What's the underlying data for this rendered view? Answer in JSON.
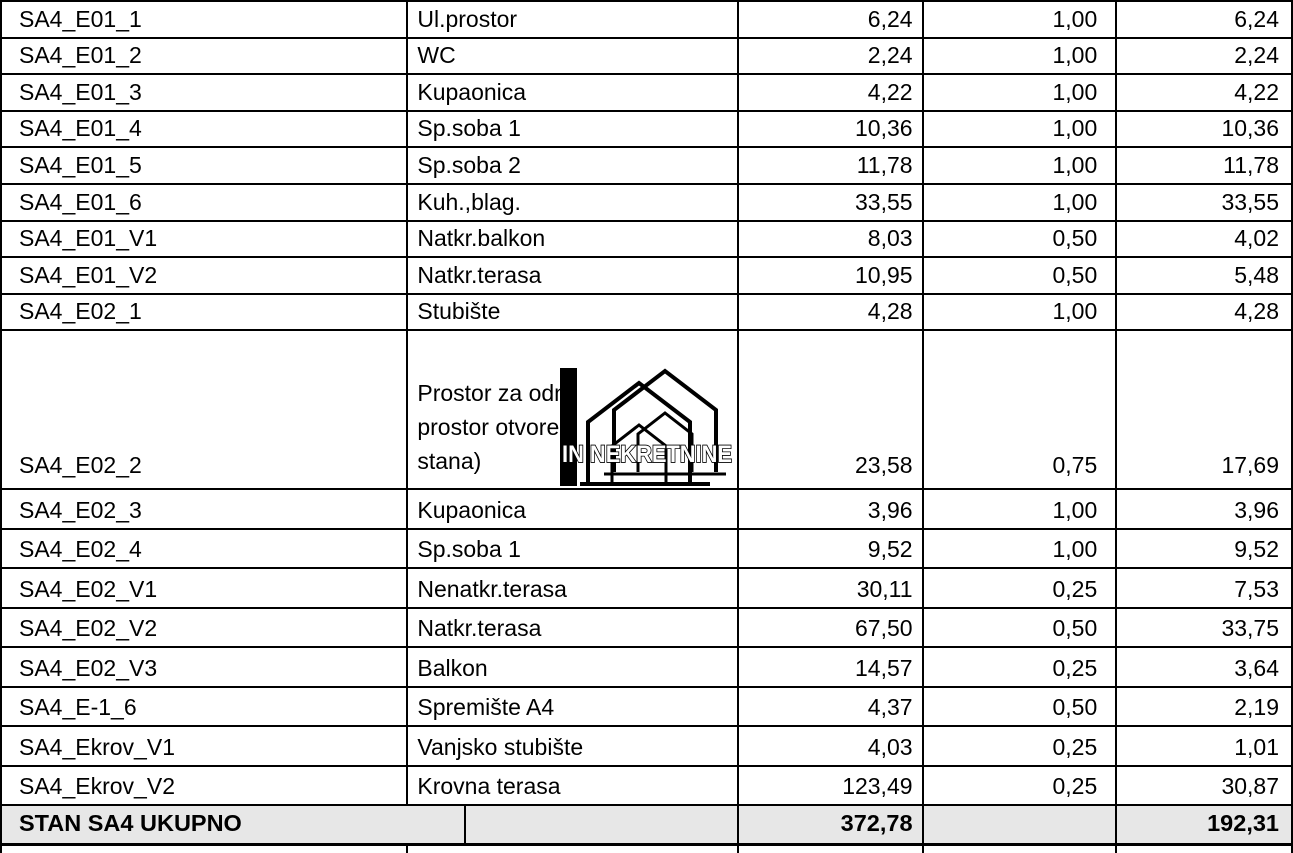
{
  "watermark": {
    "text": "IN NEKRETNINE"
  },
  "colors": {
    "border": "#000000",
    "text": "#000000",
    "total_row_bg": "#e7e7e7"
  },
  "table": {
    "rows": [
      {
        "kind": "regular",
        "id": "SA4_E01_1",
        "name": "Ul.prostor",
        "area": "6,24",
        "coef": "1,00",
        "result": "6,24"
      },
      {
        "kind": "regular",
        "id": "SA4_E01_2",
        "name": "WC",
        "area": "2,24",
        "coef": "1,00",
        "result": "2,24"
      },
      {
        "kind": "regular",
        "id": "SA4_E01_3",
        "name": "Kupaonica",
        "area": "4,22",
        "coef": "1,00",
        "result": "4,22"
      },
      {
        "kind": "regular",
        "id": "SA4_E01_4",
        "name": "Sp.soba 1",
        "area": "10,36",
        "coef": "1,00",
        "result": "10,36"
      },
      {
        "kind": "regular",
        "id": "SA4_E01_5",
        "name": "Sp.soba 2",
        "area": "11,78",
        "coef": "1,00",
        "result": "11,78"
      },
      {
        "kind": "regular",
        "id": "SA4_E01_6",
        "name": "Kuh.,blag.",
        "area": "33,55",
        "coef": "1,00",
        "result": "33,55"
      },
      {
        "kind": "regular",
        "id": "SA4_E01_V1",
        "name": "Natkr.balkon",
        "area": "8,03",
        "coef": "0,50",
        "result": "4,02"
      },
      {
        "kind": "regular",
        "id": "SA4_E01_V2",
        "name": "Natkr.terasa",
        "area": "10,95",
        "coef": "0,50",
        "result": "5,48"
      },
      {
        "kind": "regular",
        "id": "SA4_E02_1",
        "name": "Stubište",
        "area": "4,28",
        "coef": "1,00",
        "result": "4,28"
      },
      {
        "kind": "tall",
        "id": "SA4_E02_2",
        "name": "Prostor za odm\nprostor otvoren\nstana)",
        "area": "23,58",
        "coef": "0,75",
        "result": "17,69"
      },
      {
        "kind": "regular",
        "id": "SA4_E02_3",
        "name": "Kupaonica",
        "area": "3,96",
        "coef": "1,00",
        "result": "3,96"
      },
      {
        "kind": "regular",
        "id": "SA4_E02_4",
        "name": "Sp.soba 1",
        "area": "9,52",
        "coef": "1,00",
        "result": "9,52"
      },
      {
        "kind": "regular",
        "id": "SA4_E02_V1",
        "name": "Nenatkr.terasa",
        "area": "30,11",
        "coef": "0,25",
        "result": "7,53"
      },
      {
        "kind": "regular",
        "id": "SA4_E02_V2",
        "name": "Natkr.terasa",
        "area": "67,50",
        "coef": "0,50",
        "result": "33,75"
      },
      {
        "kind": "regular",
        "id": "SA4_E02_V3",
        "name": "Balkon",
        "area": "14,57",
        "coef": "0,25",
        "result": "3,64"
      },
      {
        "kind": "regular",
        "id": "SA4_E-1_6",
        "name": "Spremište A4",
        "area": "4,37",
        "coef": "0,50",
        "result": "2,19"
      },
      {
        "kind": "regular",
        "id": "SA4_Ekrov_V1",
        "name": "Vanjsko stubište",
        "area": "4,03",
        "coef": "0,25",
        "result": "1,01"
      },
      {
        "kind": "regular",
        "id": "SA4_Ekrov_V2",
        "name": "Krovna terasa",
        "area": "123,49",
        "coef": "0,25",
        "result": "30,87"
      },
      {
        "kind": "total",
        "id": "STAN SA4 UKUPNO",
        "name": "",
        "area": "372,78",
        "coef": "",
        "result": "192,31"
      },
      {
        "kind": "stub",
        "id": "",
        "name": "",
        "area": "",
        "coef": "",
        "result": ""
      }
    ]
  }
}
